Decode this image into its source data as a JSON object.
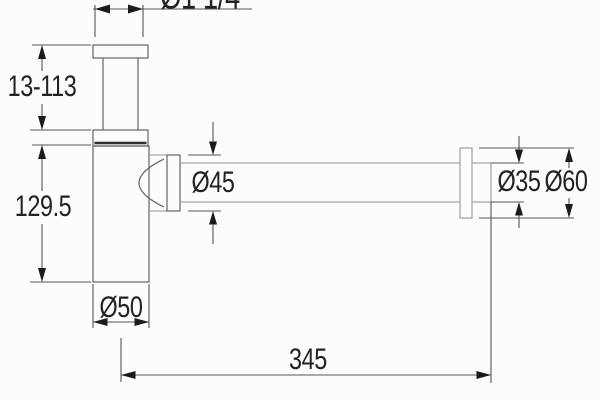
{
  "drawing": {
    "type": "technical-dimension-drawing",
    "subject": "bottle-trap-siphon",
    "colors": {
      "background": "#fcfcfc",
      "part_line": "#6f6f6f",
      "tube_line": "#a5a5a5",
      "dimension_line": "#565656",
      "arrow": "#1b1b1b",
      "text": "#222222"
    }
  },
  "labels": {
    "inlet_thread_diameter": "Ø1 1/4",
    "inlet_adjustable_height": "13-113",
    "body_height": "129.5",
    "outlet_nut_diameter": "Ø45",
    "wall_tube_diameter": "Ø35",
    "wall_flange_diameter": "Ø60",
    "body_diameter": "Ø50",
    "tube_length": "345"
  }
}
